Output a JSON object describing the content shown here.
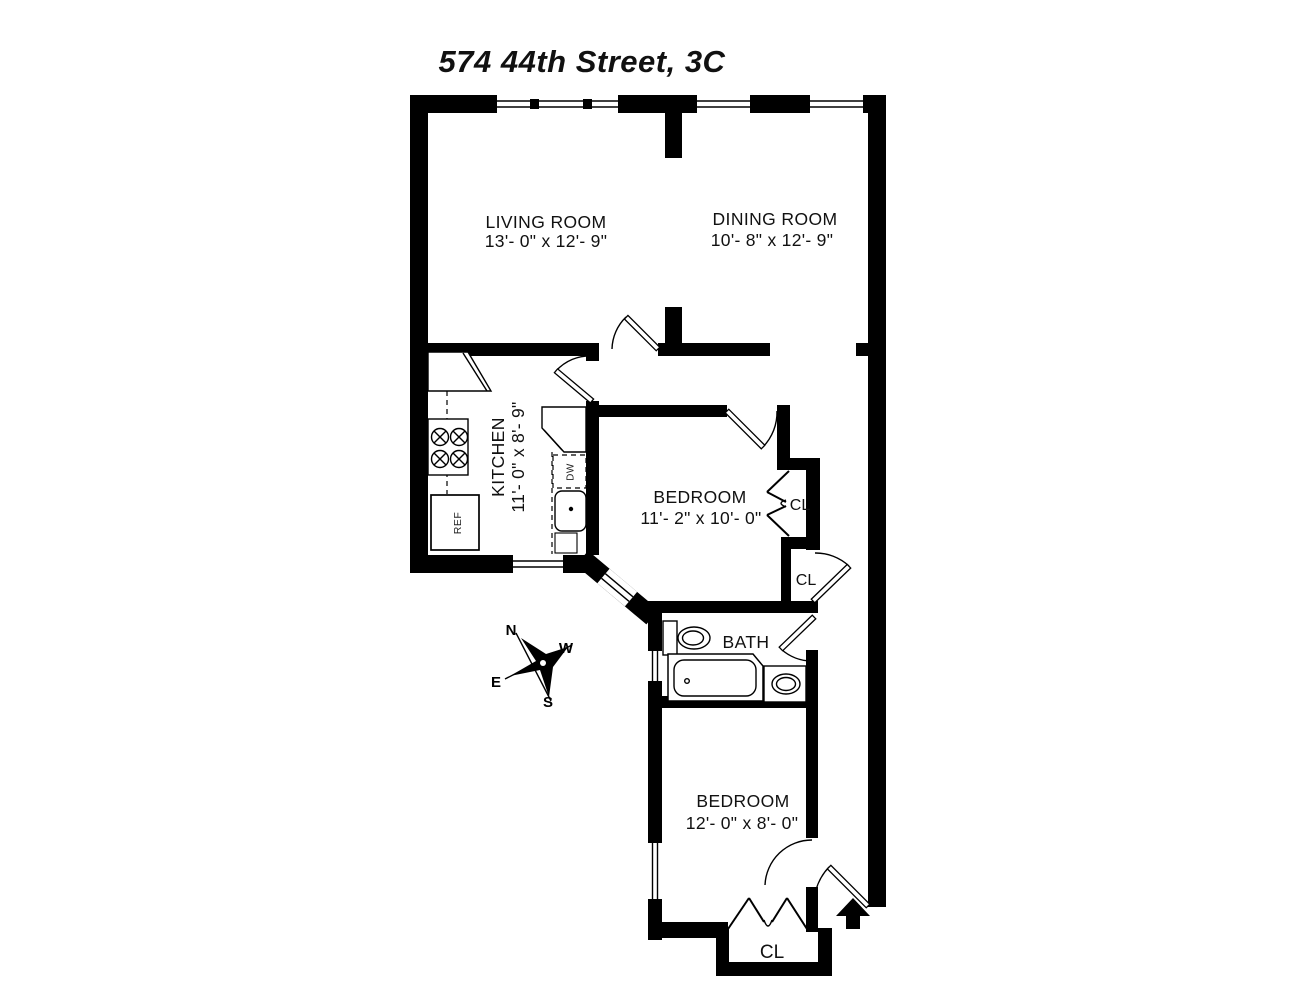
{
  "title": "574 44th Street, 3C",
  "rooms": {
    "living_room": {
      "name": "LIVING ROOM",
      "dims": "13'- 0\" x 12'- 9\""
    },
    "dining_room": {
      "name": "DINING ROOM",
      "dims": "10'- 8\" x 12'- 9\""
    },
    "kitchen": {
      "name": "KITCHEN",
      "dims": "11'- 0\" x 8'- 9\""
    },
    "bedroom_1": {
      "name": "BEDROOM",
      "dims": "11'- 2\" x 10'- 0\""
    },
    "bedroom_2": {
      "name": "BEDROOM",
      "dims": "12'- 0\" x 8'- 0\""
    },
    "bath": {
      "name": "BATH"
    },
    "closet_1": {
      "name": "CL"
    },
    "closet_2": {
      "name": "CL"
    },
    "closet_3": {
      "name": "CL"
    }
  },
  "appliances": {
    "refrigerator": "REF",
    "dishwasher": "DW"
  },
  "compass": {
    "north": "N",
    "south": "S",
    "east": "E",
    "west": "W"
  },
  "colors": {
    "wall": "#000000",
    "background": "#ffffff"
  }
}
